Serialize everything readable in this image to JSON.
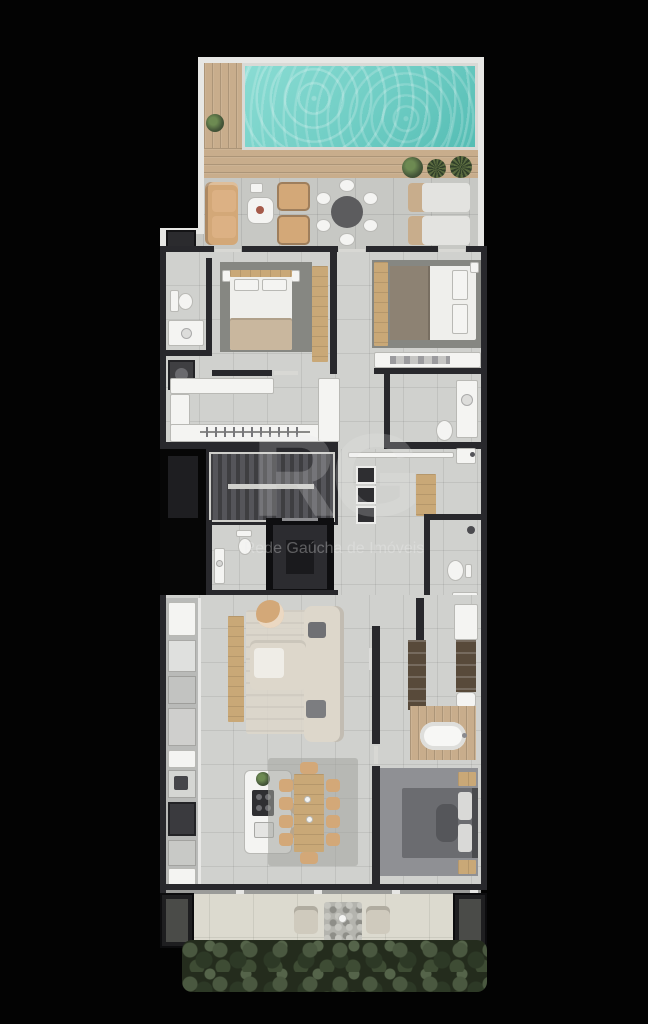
{
  "watermark": {
    "logo": "RG",
    "subtitle": "Rede Gaúcha de Imóveis"
  },
  "palette": {
    "background": "#030303",
    "wall_dark": "#28282c",
    "wall_light": "#e7e7e4",
    "floor": "#d0d1ce",
    "terrace_floor": "#c7c8c4",
    "patio_floor": "#dcdacf",
    "deck_wood": "#c8ad8c",
    "pool_water": "#6fcdc4",
    "furniture_wood": "#c9a877",
    "sofa_tan": "#d3a878",
    "sofa_cream": "#ddd7cb",
    "rug_dark": "#868782",
    "carpet_gray": "#8f9094",
    "fixture_white": "#f4f4f2",
    "stair_dark": "#4a4a4d",
    "hedge_green": "#3c4836",
    "elevator_dark": "#1d1d20"
  }
}
